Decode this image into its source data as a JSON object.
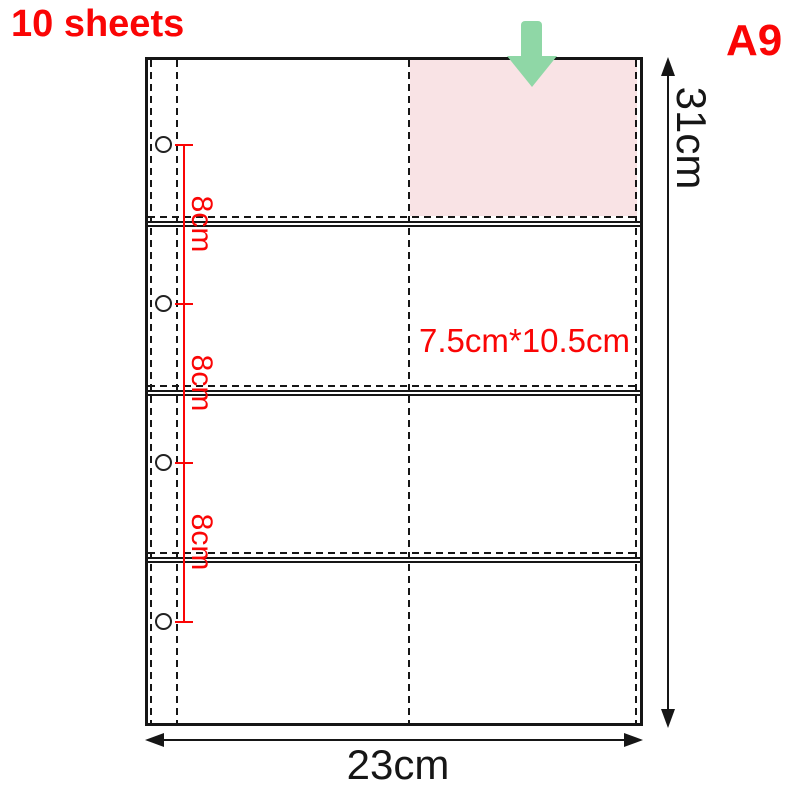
{
  "header": {
    "sheet_count": "10 sheets",
    "size_code": "A9"
  },
  "dimensions": {
    "sheet_height": "31cm",
    "sheet_width": "23cm",
    "pocket_size": "7.5cm*10.5cm",
    "hole_spacing": [
      "8cm",
      "8cm",
      "8cm"
    ]
  },
  "diagram": {
    "rows": 4,
    "columns": 2,
    "binder_holes": 4,
    "highlighted_pocket": "top-right",
    "insert_arrow_icon": "down-arrow"
  },
  "colors": {
    "accent_red": "#fa0505",
    "line_black": "#161616",
    "pocket_highlight_pink": "#f9e3e5",
    "arrow_green": "#8fd7a6"
  }
}
